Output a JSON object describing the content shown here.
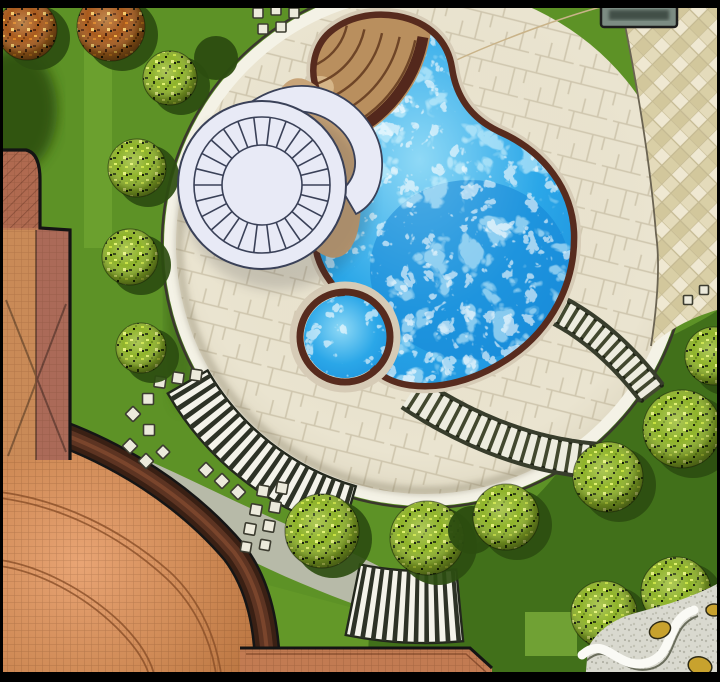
{
  "palette": {
    "frame": "#000000",
    "lawn": "#5d9226",
    "lawnDark": "#41701a",
    "lawnLight": "#79ad36",
    "treeShadow": "#2c4d10",
    "paving": "#eae4d0",
    "pavingJoint": "#cfc6ae",
    "diamondA": "#efe8d2",
    "diamondB": "#d9cfa6",
    "diamondJoint": "#c4b992",
    "plazaEdge": "#3a382c",
    "rim": "#f4f2e6",
    "poolBlue": "#2ba7e8",
    "poolDeep": "#1282d4",
    "coping": "#572b1e",
    "copingHalo": "#d6cbb6",
    "stepsTan": "#b98f5e",
    "stepsLine": "#6e4527",
    "stepsDark": "#53281c",
    "struct": "#e8eaf6",
    "ink": "#3a4158",
    "terra": "#c7834c",
    "terraHi": "#efa87c",
    "terraLine": "#8a4f28",
    "bandDark": "#3a2014",
    "band2": "#5d3422",
    "band3": "#7a452c",
    "gray": "#b7baa8",
    "stone": "#eceadb",
    "stoneEdge": "#3c3c30",
    "zebraDark": "#2d3226",
    "zebraLight": "#f4f3ea",
    "ladderRail": "#383d2c",
    "ladderBg": "#edecdf",
    "ladderDot": "#1e2214",
    "gravel": "#d9d9cf",
    "ribbon": "#fafaf5",
    "gold": "#c8a22e",
    "chip": "#7c8c83",
    "chipDark": "#39453e",
    "building": "#bd7a55"
  },
  "scene": {
    "trees": [
      {
        "type": "autumn",
        "x": 27,
        "y": 30,
        "r": 30
      },
      {
        "type": "autumn",
        "x": 111,
        "y": 27,
        "r": 34
      },
      {
        "type": "yellow",
        "x": 170,
        "y": 78,
        "r": 27
      },
      {
        "type": "yellow",
        "x": 137,
        "y": 168,
        "r": 29
      },
      {
        "type": "yellow",
        "x": 130,
        "y": 257,
        "r": 28
      },
      {
        "type": "yellow",
        "x": 141,
        "y": 348,
        "r": 25
      },
      {
        "type": "shadow",
        "x": 216,
        "y": 58,
        "r": 22
      },
      {
        "type": "yellow",
        "x": 322,
        "y": 531,
        "r": 37
      },
      {
        "type": "yellow",
        "x": 427,
        "y": 538,
        "r": 37
      },
      {
        "type": "shadow",
        "x": 472,
        "y": 530,
        "r": 24
      },
      {
        "type": "yellow",
        "x": 506,
        "y": 517,
        "r": 33
      },
      {
        "type": "yellow",
        "x": 608,
        "y": 477,
        "r": 35
      },
      {
        "type": "yellow",
        "x": 682,
        "y": 429,
        "r": 39
      },
      {
        "type": "yellow",
        "x": 714,
        "y": 356,
        "r": 29
      },
      {
        "type": "yellow",
        "x": 604,
        "y": 614,
        "r": 33
      },
      {
        "type": "yellow",
        "x": 676,
        "y": 592,
        "r": 35
      }
    ],
    "stones": [
      {
        "x": 258,
        "y": 13,
        "s": 10,
        "rot": 0
      },
      {
        "x": 276,
        "y": 10,
        "s": 10,
        "rot": 0
      },
      {
        "x": 294,
        "y": 13,
        "s": 10,
        "rot": 0
      },
      {
        "x": 263,
        "y": 29,
        "s": 10,
        "rot": 0
      },
      {
        "x": 281,
        "y": 27,
        "s": 10,
        "rot": 0
      },
      {
        "x": 160,
        "y": 382,
        "s": 11,
        "rot": 8
      },
      {
        "x": 178,
        "y": 378,
        "s": 11,
        "rot": 8
      },
      {
        "x": 196,
        "y": 375,
        "s": 11,
        "rot": 8
      },
      {
        "x": 148,
        "y": 399,
        "s": 11,
        "rot": 0
      },
      {
        "x": 133,
        "y": 414,
        "s": 11,
        "rot": 45
      },
      {
        "x": 149,
        "y": 430,
        "s": 11,
        "rot": 0
      },
      {
        "x": 130,
        "y": 446,
        "s": 11,
        "rot": 45
      },
      {
        "x": 146,
        "y": 461,
        "s": 11,
        "rot": 45
      },
      {
        "x": 163,
        "y": 452,
        "s": 10,
        "rot": 45
      },
      {
        "x": 206,
        "y": 470,
        "s": 11,
        "rot": 45
      },
      {
        "x": 222,
        "y": 481,
        "s": 11,
        "rot": 45
      },
      {
        "x": 238,
        "y": 492,
        "s": 11,
        "rot": 45
      },
      {
        "x": 263,
        "y": 491,
        "s": 11,
        "rot": 10
      },
      {
        "x": 282,
        "y": 488,
        "s": 11,
        "rot": 10
      },
      {
        "x": 256,
        "y": 510,
        "s": 11,
        "rot": 10
      },
      {
        "x": 275,
        "y": 507,
        "s": 11,
        "rot": 10
      },
      {
        "x": 250,
        "y": 529,
        "s": 11,
        "rot": 10
      },
      {
        "x": 269,
        "y": 526,
        "s": 11,
        "rot": 10
      },
      {
        "x": 246,
        "y": 547,
        "s": 10,
        "rot": 10
      },
      {
        "x": 265,
        "y": 545,
        "s": 10,
        "rot": 10
      },
      {
        "x": 688,
        "y": 300,
        "s": 9,
        "rot": 0
      },
      {
        "x": 704,
        "y": 290,
        "s": 9,
        "rot": 0
      }
    ],
    "zebra_bands": [
      {
        "cx": 425,
        "cy": 245,
        "r0": 251,
        "r1": 297,
        "a0": 106,
        "a1": 150,
        "n": 20
      },
      {
        "cx": 425,
        "cy": 245,
        "r0": 326,
        "r1": 398,
        "a0": 84.5,
        "a1": 101.5,
        "n": 11
      }
    ],
    "ladders": [
      {
        "d": "M549,306 Q606,332 654,396",
        "w": 28,
        "gap": 10
      },
      {
        "d": "M411,393 Q505,455 601,461",
        "w": 34,
        "gap": 11
      }
    ],
    "spokes": {
      "cx": 262,
      "cy": 185,
      "r0": 40,
      "r1": 68,
      "count": 26
    },
    "fan_steps": {
      "cx": 292,
      "cy": 14,
      "radii": [
        38,
        56,
        74,
        92,
        110,
        126
      ]
    },
    "gold_stones": [
      {
        "x": 660,
        "y": 630,
        "rx": 11,
        "ry": 8,
        "rot": -25
      },
      {
        "x": 700,
        "y": 666,
        "rx": 12,
        "ry": 9,
        "rot": 15
      },
      {
        "x": 714,
        "y": 610,
        "rx": 8,
        "ry": 6,
        "rot": 0
      }
    ]
  }
}
